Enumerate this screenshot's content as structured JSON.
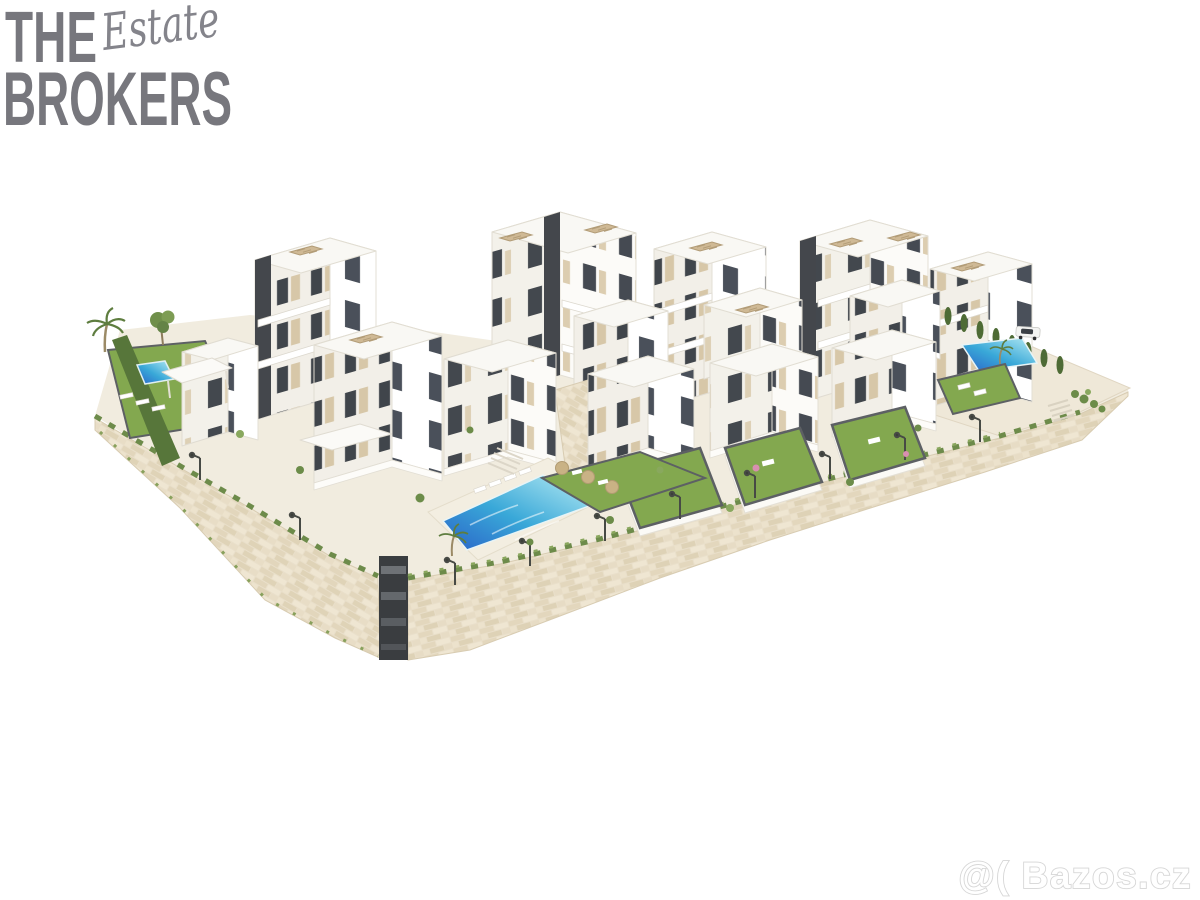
{
  "page": {
    "background": "#ffffff",
    "kind": "real-estate listing render"
  },
  "logo": {
    "line1": "THE",
    "script": "Estate",
    "line2": "BROKERS",
    "color": "#77777d",
    "script_color": "#84848b"
  },
  "watermark": {
    "text": "@( Bazos.cz",
    "fill": "#ffffff",
    "outline": "#d6d6d6"
  },
  "scene": {
    "description": "Aerial 3D render of a terraced white apartment complex on a hillside: modern blocks with rooftop pergolas and dark accent strips, private lawns, a main infinity pool with sun loungers and umbrellas, a small pool on the left garden, a third pool on the right plateau with a parked white car, cypress hedges, palm trees, street lamps and long beige stone retaining walls.",
    "colors": {
      "building_white": "#ffffff",
      "building_shade": "#f2efe8",
      "facade_tan": "#d7c7a8",
      "accent_dark": "#44474c",
      "window": "#40454b",
      "pool_deep": "#2a63c8",
      "pool_mid": "#39a8d8",
      "pool_light": "#b8ecf4",
      "lawn": "#83a84f",
      "hedge": "#57763a",
      "stone_wall": "#e9dfca",
      "pavement": "#f1ecdf",
      "pergola_tan": "#cfb995",
      "terrace_edge": "#5d6064"
    },
    "features": [
      "white apartment blocks with rooftop pergolas",
      "dark charcoal facade accent strips",
      "tan window panels and balconies",
      "main swimming pool with loungers and umbrellas",
      "left garden pool",
      "right plateau pool",
      "stepped private lawns",
      "beige stone retaining walls",
      "cypress hedge row",
      "palm trees",
      "street lamps",
      "parked white car"
    ]
  }
}
